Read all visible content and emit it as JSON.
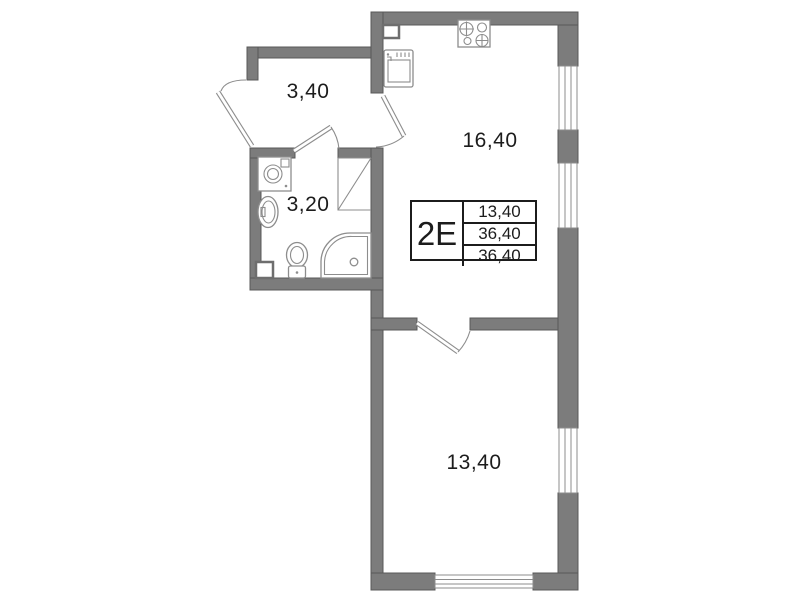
{
  "colors": {
    "wall": "#7c7c7c",
    "wallEdge": "#585858",
    "line": "#8d8d8d",
    "text": "#1c1c1c",
    "bg": "#ffffff"
  },
  "rooms": [
    {
      "id": "hallway",
      "area": "3,40"
    },
    {
      "id": "bathroom",
      "area": "3,20"
    },
    {
      "id": "kitchen-living",
      "area": "16,40"
    },
    {
      "id": "bedroom",
      "area": "13,40"
    }
  ],
  "info_table": {
    "unit": "2E",
    "rows": [
      "13,40",
      "36,40",
      "36,40"
    ]
  }
}
